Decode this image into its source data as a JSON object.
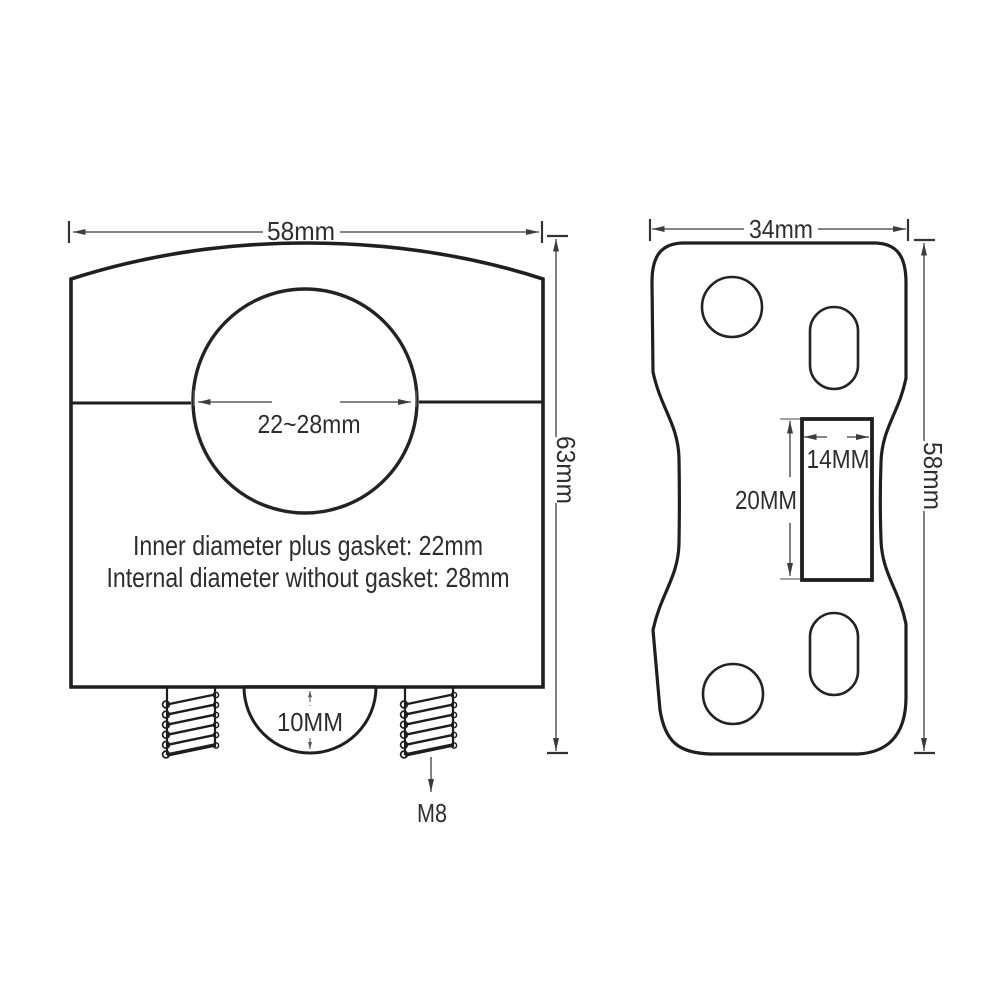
{
  "colors": {
    "background": "#ffffff",
    "outline": "#1f1f1f",
    "dimension": "#3c3c3c",
    "text": "#2e2e2e"
  },
  "front_view": {
    "width_dim": "58mm",
    "height_dim": "63mm",
    "bore_dim": "22~28mm",
    "note_line1": "Inner diameter plus gasket: 22mm",
    "note_line2": "Internal diameter without gasket: 28mm",
    "boss_dim": "10MM",
    "stud_thread": "M8"
  },
  "top_view": {
    "width_dim": "34mm",
    "height_dim": "58mm",
    "slot_width_dim": "14MM",
    "slot_depth_dim": "20MM"
  }
}
